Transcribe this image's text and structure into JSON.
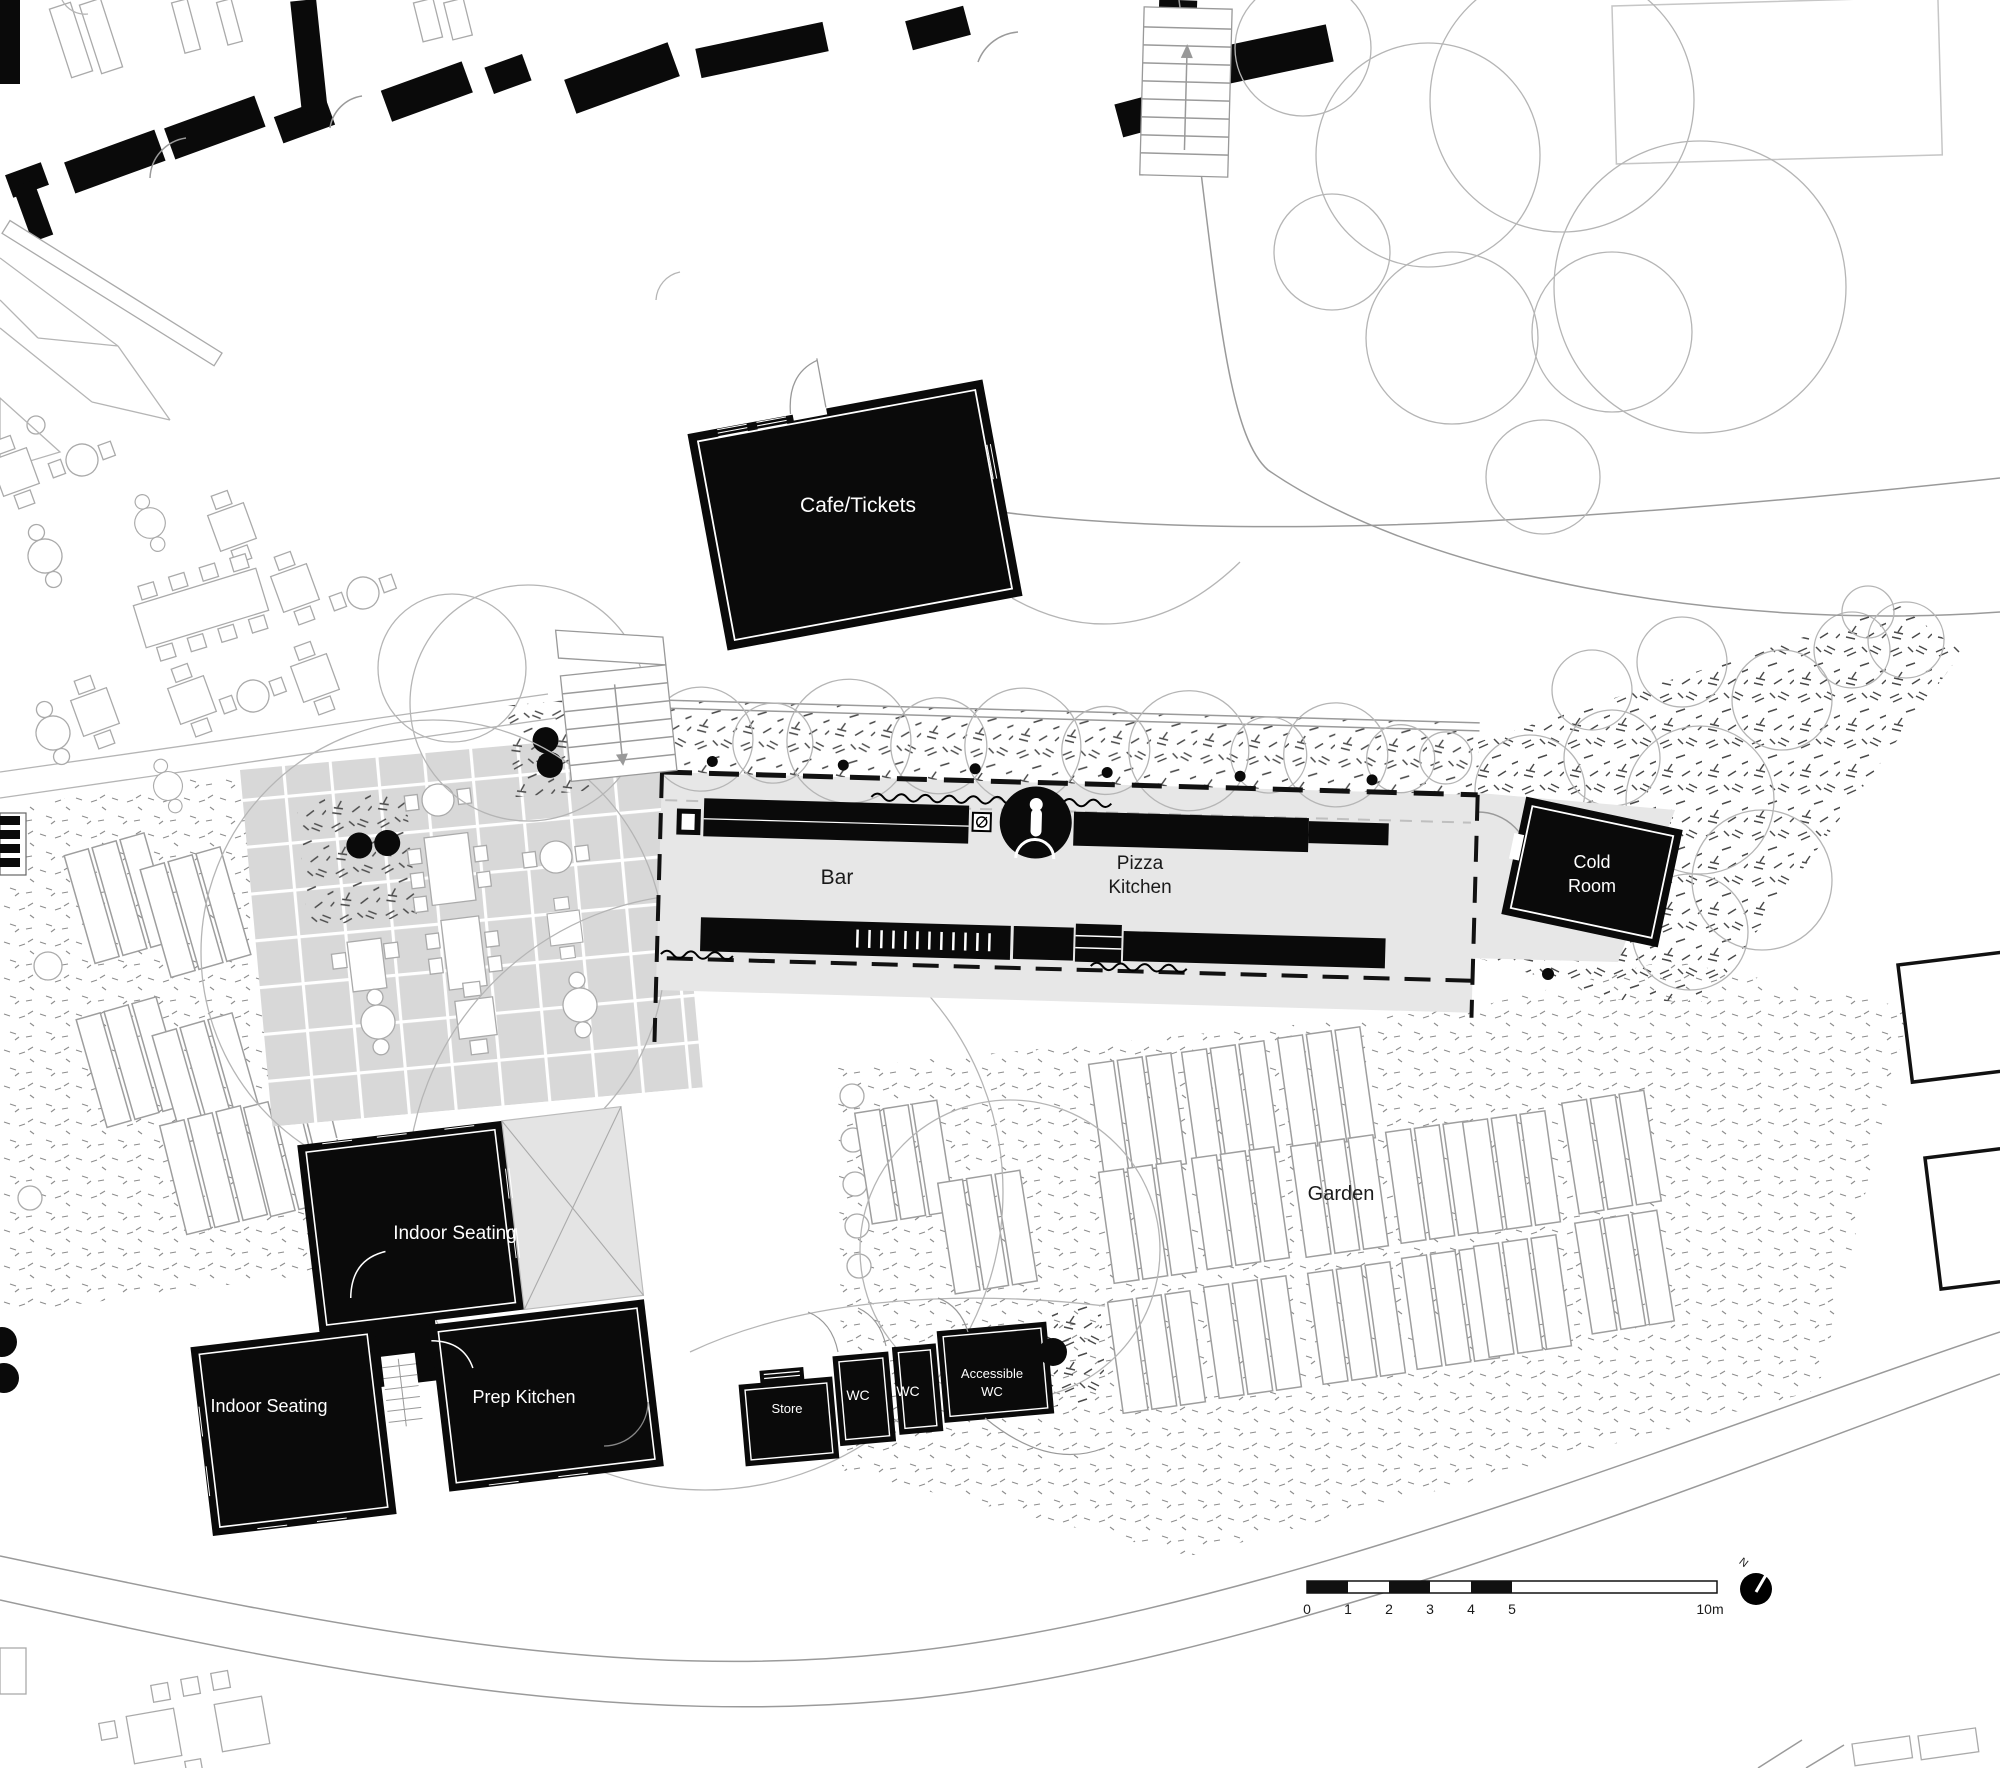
{
  "labels": {
    "cafe_tickets": "Cafe/Tickets",
    "bar": "Bar",
    "pizza_line1": "Pizza",
    "pizza_line2": "Kitchen",
    "cold_line1": "Cold",
    "cold_line2": "Room",
    "indoor_seating_main": "Indoor Seating",
    "indoor_seating_west": "Indoor Seating",
    "prep_kitchen": "Prep Kitchen",
    "store": "Store",
    "wc_left": "WC",
    "wc_right": "WC",
    "accessible_line1": "Accessible",
    "accessible_line2": "WC",
    "garden": "Garden"
  },
  "scale_bar": {
    "tick_0": "0",
    "tick_1": "1",
    "tick_2": "2",
    "tick_3": "3",
    "tick_4": "4",
    "tick_5": "5",
    "end_label": "10m"
  },
  "north_arrow": {
    "label": "N"
  },
  "colors": {
    "ink": "#000000",
    "paper": "#ffffff",
    "slab_grey": "#e7e7e7",
    "tile_grey": "#d8d8d8",
    "line_grey": "#999999",
    "faint_grey": "#bbbbbb"
  }
}
